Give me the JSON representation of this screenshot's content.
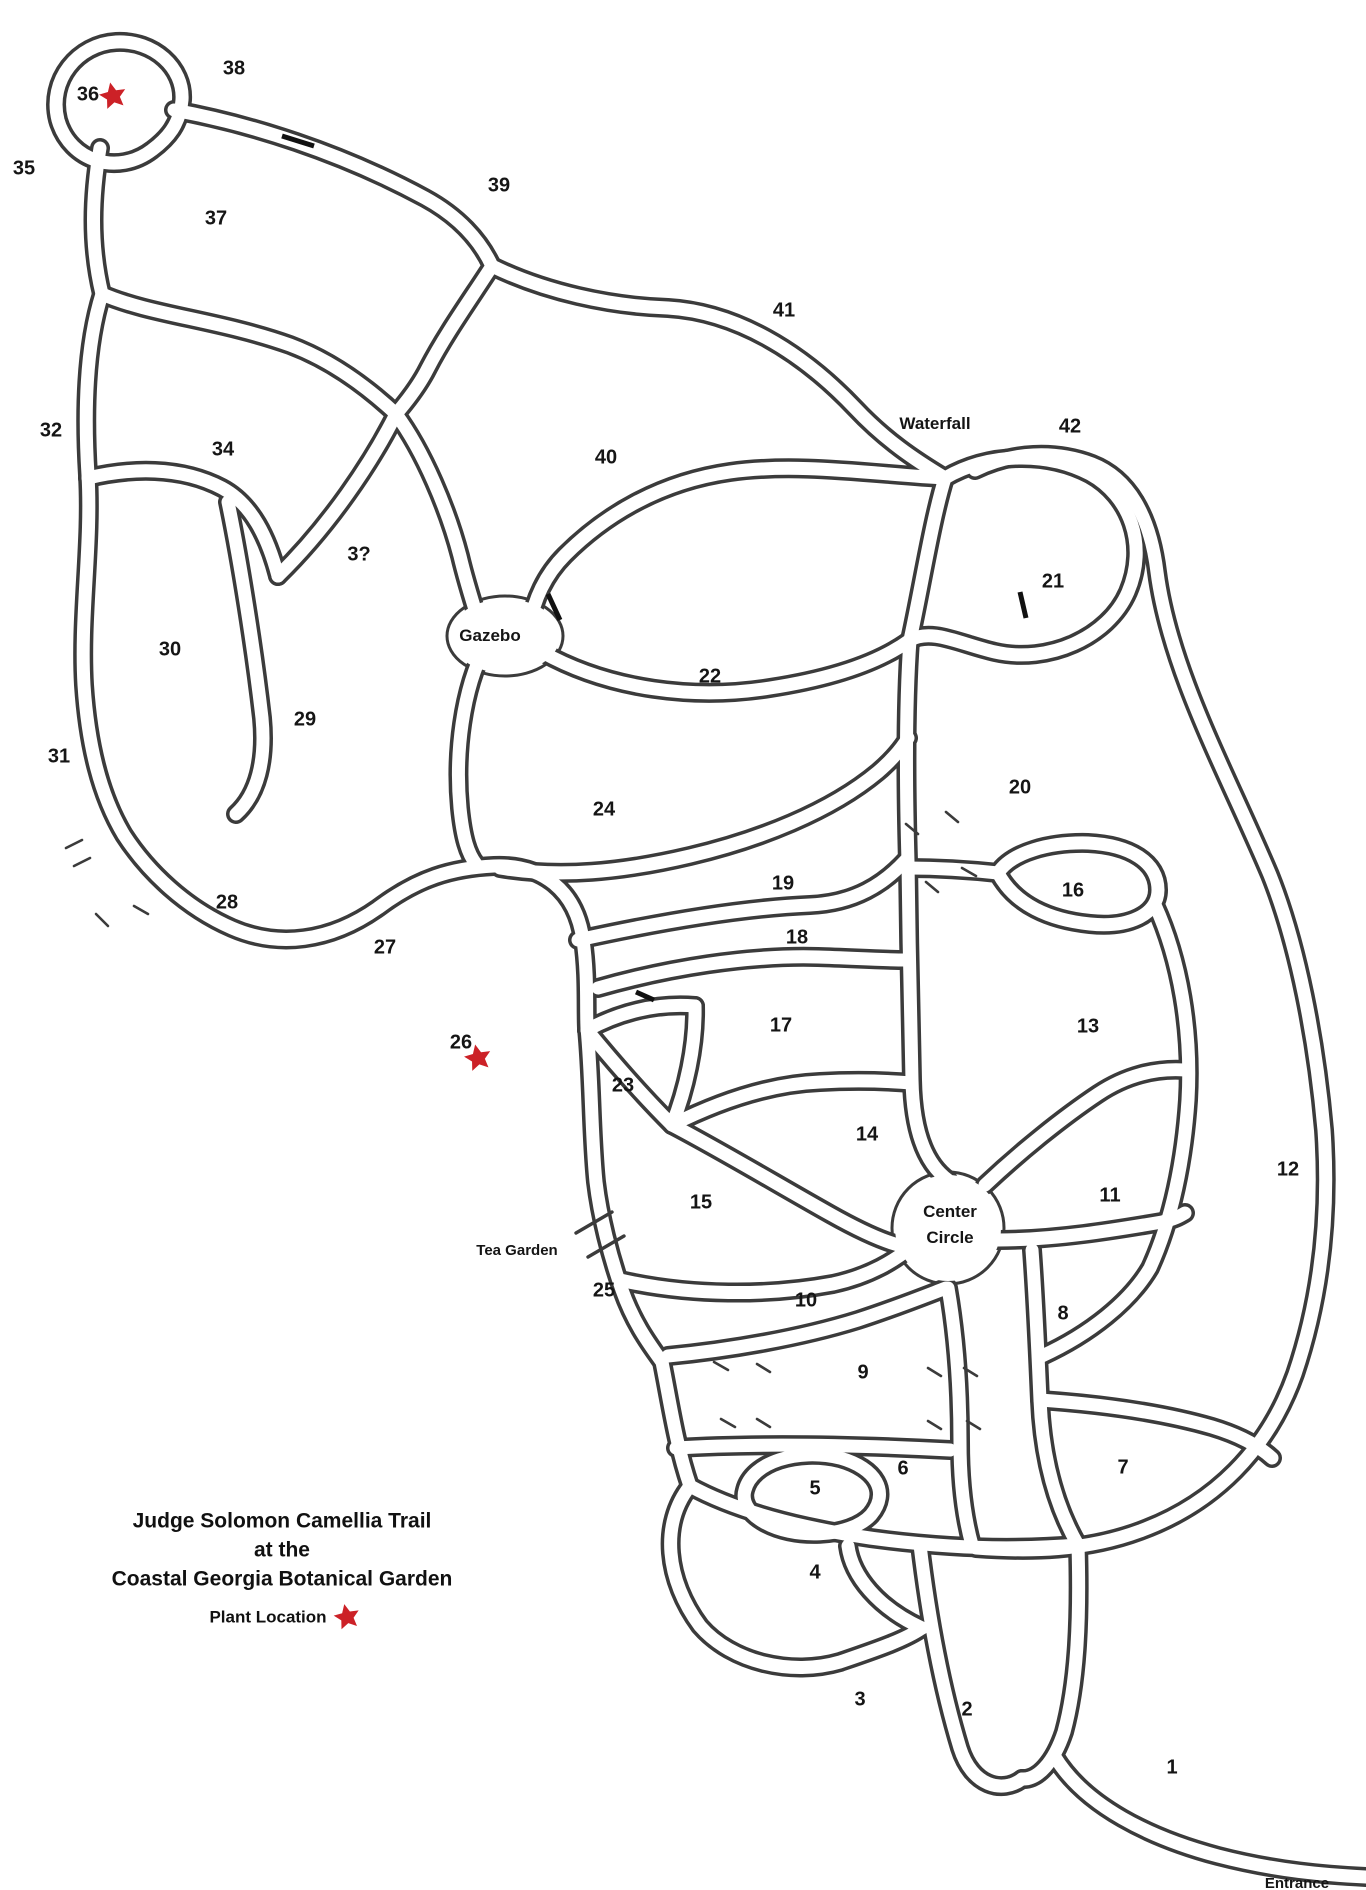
{
  "title": {
    "line1": "Judge Solomon Camellia Trail",
    "line2": "at the",
    "line3": "Coastal Georgia Botanical Garden"
  },
  "legend": {
    "label": "Plant Location"
  },
  "map": {
    "colors": {
      "background": "#ffffff",
      "path_outline": "#3b3b3b",
      "star": "#cc2127",
      "text": "#151515"
    },
    "bed_labels": [
      {
        "id": "1",
        "text": "1",
        "x": 1172,
        "y": 1768
      },
      {
        "id": "2",
        "text": "2",
        "x": 967,
        "y": 1710
      },
      {
        "id": "3",
        "text": "3",
        "x": 860,
        "y": 1700
      },
      {
        "id": "4",
        "text": "4",
        "x": 815,
        "y": 1573
      },
      {
        "id": "5",
        "text": "5",
        "x": 815,
        "y": 1489
      },
      {
        "id": "6",
        "text": "6",
        "x": 903,
        "y": 1469
      },
      {
        "id": "7",
        "text": "7",
        "x": 1123,
        "y": 1468
      },
      {
        "id": "8",
        "text": "8",
        "x": 1063,
        "y": 1314
      },
      {
        "id": "9",
        "text": "9",
        "x": 863,
        "y": 1373
      },
      {
        "id": "10",
        "text": "10",
        "x": 806,
        "y": 1301
      },
      {
        "id": "11",
        "text": "11",
        "x": 1110,
        "y": 1196
      },
      {
        "id": "12",
        "text": "12",
        "x": 1288,
        "y": 1170
      },
      {
        "id": "13",
        "text": "13",
        "x": 1088,
        "y": 1027
      },
      {
        "id": "14",
        "text": "14",
        "x": 867,
        "y": 1135
      },
      {
        "id": "15",
        "text": "15",
        "x": 701,
        "y": 1203
      },
      {
        "id": "16",
        "text": "16",
        "x": 1073,
        "y": 891
      },
      {
        "id": "17",
        "text": "17",
        "x": 781,
        "y": 1026
      },
      {
        "id": "18",
        "text": "18",
        "x": 797,
        "y": 938
      },
      {
        "id": "19",
        "text": "19",
        "x": 783,
        "y": 884
      },
      {
        "id": "20",
        "text": "20",
        "x": 1020,
        "y": 788
      },
      {
        "id": "21",
        "text": "21",
        "x": 1053,
        "y": 582
      },
      {
        "id": "22",
        "text": "22",
        "x": 710,
        "y": 677
      },
      {
        "id": "23",
        "text": "23",
        "x": 623,
        "y": 1086
      },
      {
        "id": "24",
        "text": "24",
        "x": 604,
        "y": 810
      },
      {
        "id": "25",
        "text": "25",
        "x": 604,
        "y": 1291
      },
      {
        "id": "26",
        "text": "26",
        "x": 461,
        "y": 1043
      },
      {
        "id": "27",
        "text": "27",
        "x": 385,
        "y": 948
      },
      {
        "id": "28",
        "text": "28",
        "x": 227,
        "y": 903
      },
      {
        "id": "29",
        "text": "29",
        "x": 305,
        "y": 720
      },
      {
        "id": "30",
        "text": "30",
        "x": 170,
        "y": 650
      },
      {
        "id": "31",
        "text": "31",
        "x": 59,
        "y": 757
      },
      {
        "id": "32",
        "text": "32",
        "x": 51,
        "y": 431
      },
      {
        "id": "33",
        "text": "3?",
        "x": 359,
        "y": 555
      },
      {
        "id": "34",
        "text": "34",
        "x": 223,
        "y": 450
      },
      {
        "id": "35",
        "text": "35",
        "x": 24,
        "y": 169
      },
      {
        "id": "36",
        "text": "36",
        "x": 88,
        "y": 95
      },
      {
        "id": "37",
        "text": "37",
        "x": 216,
        "y": 219
      },
      {
        "id": "38",
        "text": "38",
        "x": 234,
        "y": 69
      },
      {
        "id": "39",
        "text": "39",
        "x": 499,
        "y": 186
      },
      {
        "id": "40",
        "text": "40",
        "x": 606,
        "y": 458
      },
      {
        "id": "41",
        "text": "41",
        "x": 784,
        "y": 311
      },
      {
        "id": "42",
        "text": "42",
        "x": 1070,
        "y": 427
      }
    ],
    "place_labels": [
      {
        "id": "waterfall",
        "lines": [
          "Waterfall"
        ],
        "x": 935,
        "y": 425
      },
      {
        "id": "gazebo",
        "lines": [
          "Gazebo"
        ],
        "x": 490,
        "y": 637
      },
      {
        "id": "center-circle",
        "lines": [
          "Center",
          "Circle"
        ],
        "x": 950,
        "y": 1213
      },
      {
        "id": "tea-garden",
        "lines": [
          "Tea Garden"
        ],
        "x": 517,
        "y": 1251,
        "small": true
      },
      {
        "id": "entrance",
        "lines": [
          "Entrance"
        ],
        "x": 1297,
        "y": 1884,
        "small": true
      }
    ],
    "plant_locations": [
      {
        "near_bed": "36",
        "x": 113,
        "y": 96
      },
      {
        "near_bed": "26",
        "x": 478,
        "y": 1058
      }
    ]
  }
}
